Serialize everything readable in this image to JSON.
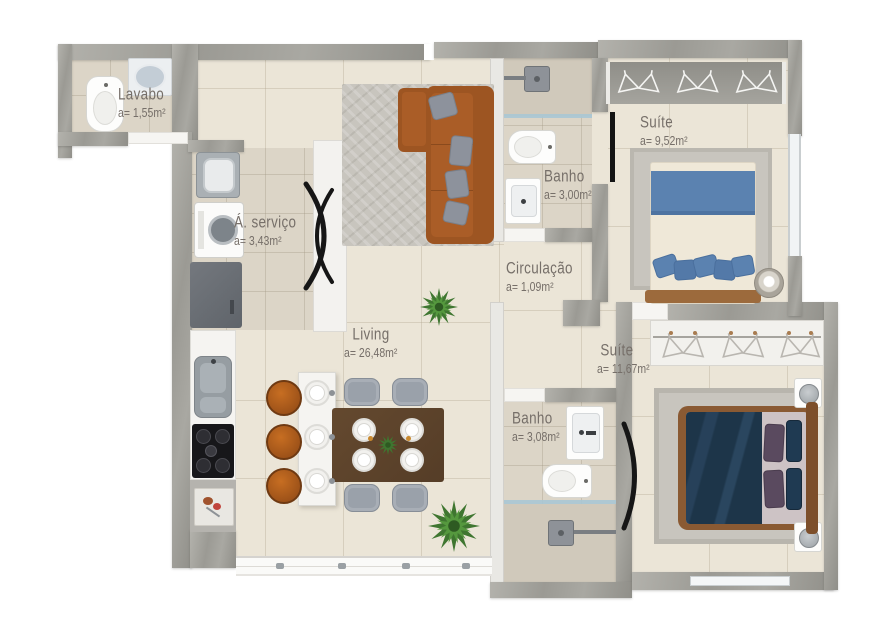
{
  "rooms": [
    {
      "id": "lavabo",
      "name": "Lavabo",
      "area": "a= 1,55m²"
    },
    {
      "id": "area-servico",
      "name": "Á. serviço",
      "area": "a= 3,43m²"
    },
    {
      "id": "banho-social",
      "name": "Banho",
      "area": "a= 3,00m²"
    },
    {
      "id": "suite-1",
      "name": "Suíte",
      "area": "a= 9,52m²"
    },
    {
      "id": "circulacao",
      "name": "Circulação",
      "area": "a= 1,09m²"
    },
    {
      "id": "living",
      "name": "Living",
      "area": "a= 26,48m²"
    },
    {
      "id": "banho-suite",
      "name": "Banho",
      "area": "a= 3,08m²"
    },
    {
      "id": "suite-2",
      "name": "Suíte",
      "area": "a= 11,67m²"
    }
  ],
  "colors": {
    "wall": "#a6a5a0",
    "wall-light": "#e9e8e4",
    "floor": "#ebe5d7",
    "floor-dark": "#dcd5c7",
    "floor-shower": "#d0c9bb",
    "rug": "#c8c5be",
    "sofa": "#9d5522",
    "sofa-seat": "#aa5d27",
    "wood": "#5e462e",
    "bed-blue": "#5b82b0",
    "bed-navy": "#1f3a52",
    "pillow-gray": "#8d929c",
    "pillow-purple": "#5a4a5f",
    "stool": "#b05d1e",
    "plant": "#4c8a38",
    "glass": "#a9c6d4",
    "label": "#766f69",
    "fixture": "#91979c",
    "white": "#f6f5f2"
  }
}
